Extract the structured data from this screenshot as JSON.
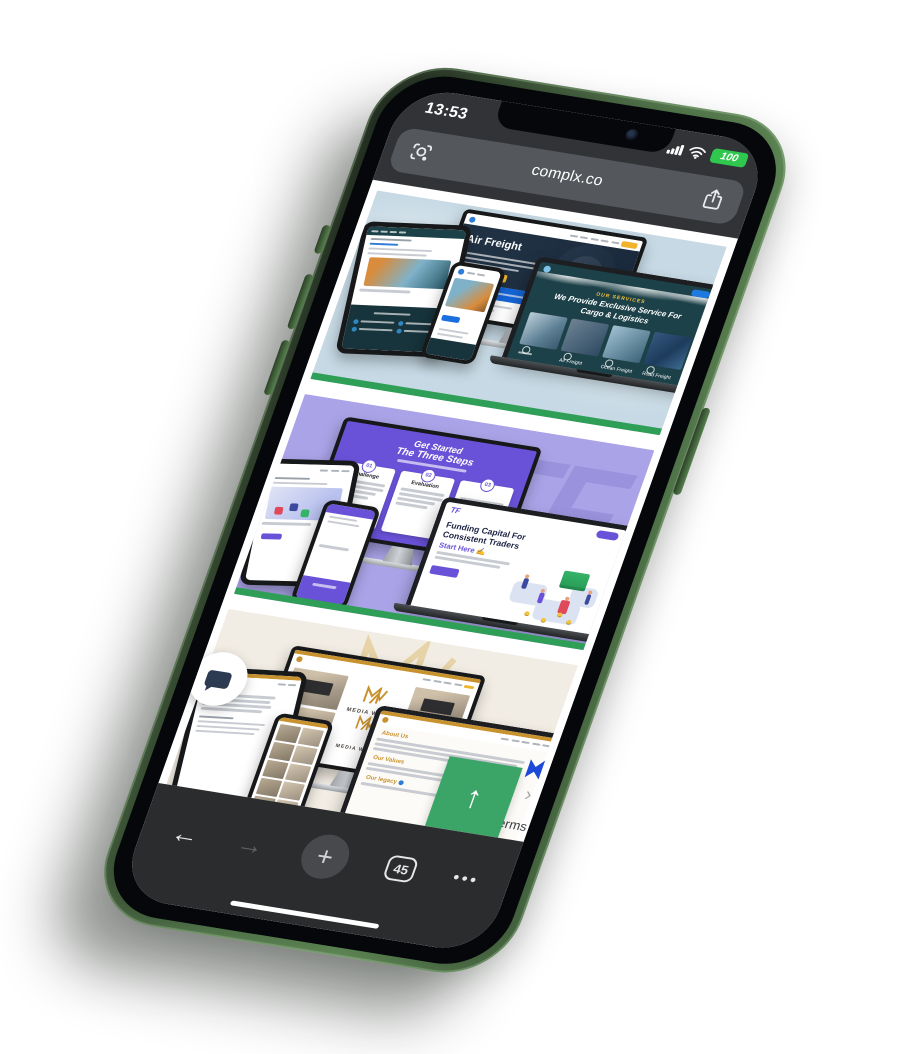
{
  "device": {
    "name": "green iphone mockup",
    "frame_color": "#4d7249"
  },
  "status_bar": {
    "time": "13:53",
    "battery_level": "100"
  },
  "browser": {
    "url": "complx.co",
    "tab_count": "45"
  },
  "icons": {
    "back": "←",
    "forward": "→",
    "new_tab": "+",
    "menu": "•••",
    "up_arrow": "↑",
    "chevron": "›"
  },
  "page": {
    "accent_green": "#2f9e57",
    "footer_partial_text": "erms",
    "sections": [
      {
        "id": "logistics-portfolio",
        "background": "#c6d9e4",
        "hero_title": "Air Freight",
        "services_label": "OUR SERVICES",
        "services_title": "We Provide Exclusive Service For Cargo & Logistics",
        "service_cards": [
          "Air Freight",
          "Ocean Freight",
          "Road Freight"
        ]
      },
      {
        "id": "prop-trading-portfolio",
        "background": "#aaa3e7",
        "watermark": "TF",
        "logo": "TF",
        "steps_title_line1": "Get Started",
        "steps_title_line2": "The Three Steps",
        "steps": [
          {
            "num": "01",
            "label": "Challenge"
          },
          {
            "num": "02",
            "label": "Evaluation"
          },
          {
            "num": "03",
            "label": ""
          }
        ],
        "laptop_title_line1": "Funding Capital For",
        "laptop_title_line2": "Consistent Traders",
        "laptop_cta": "Start Here ✍"
      },
      {
        "id": "media-walls-portfolio",
        "background": "#f2ede4",
        "watermark_left": "ME",
        "watermark_right": "LLS",
        "brand": "MEDIA WALLS",
        "about_heading": "About Us",
        "values_heading": "Our Values",
        "legacy_heading": "Our legacy"
      }
    ]
  }
}
